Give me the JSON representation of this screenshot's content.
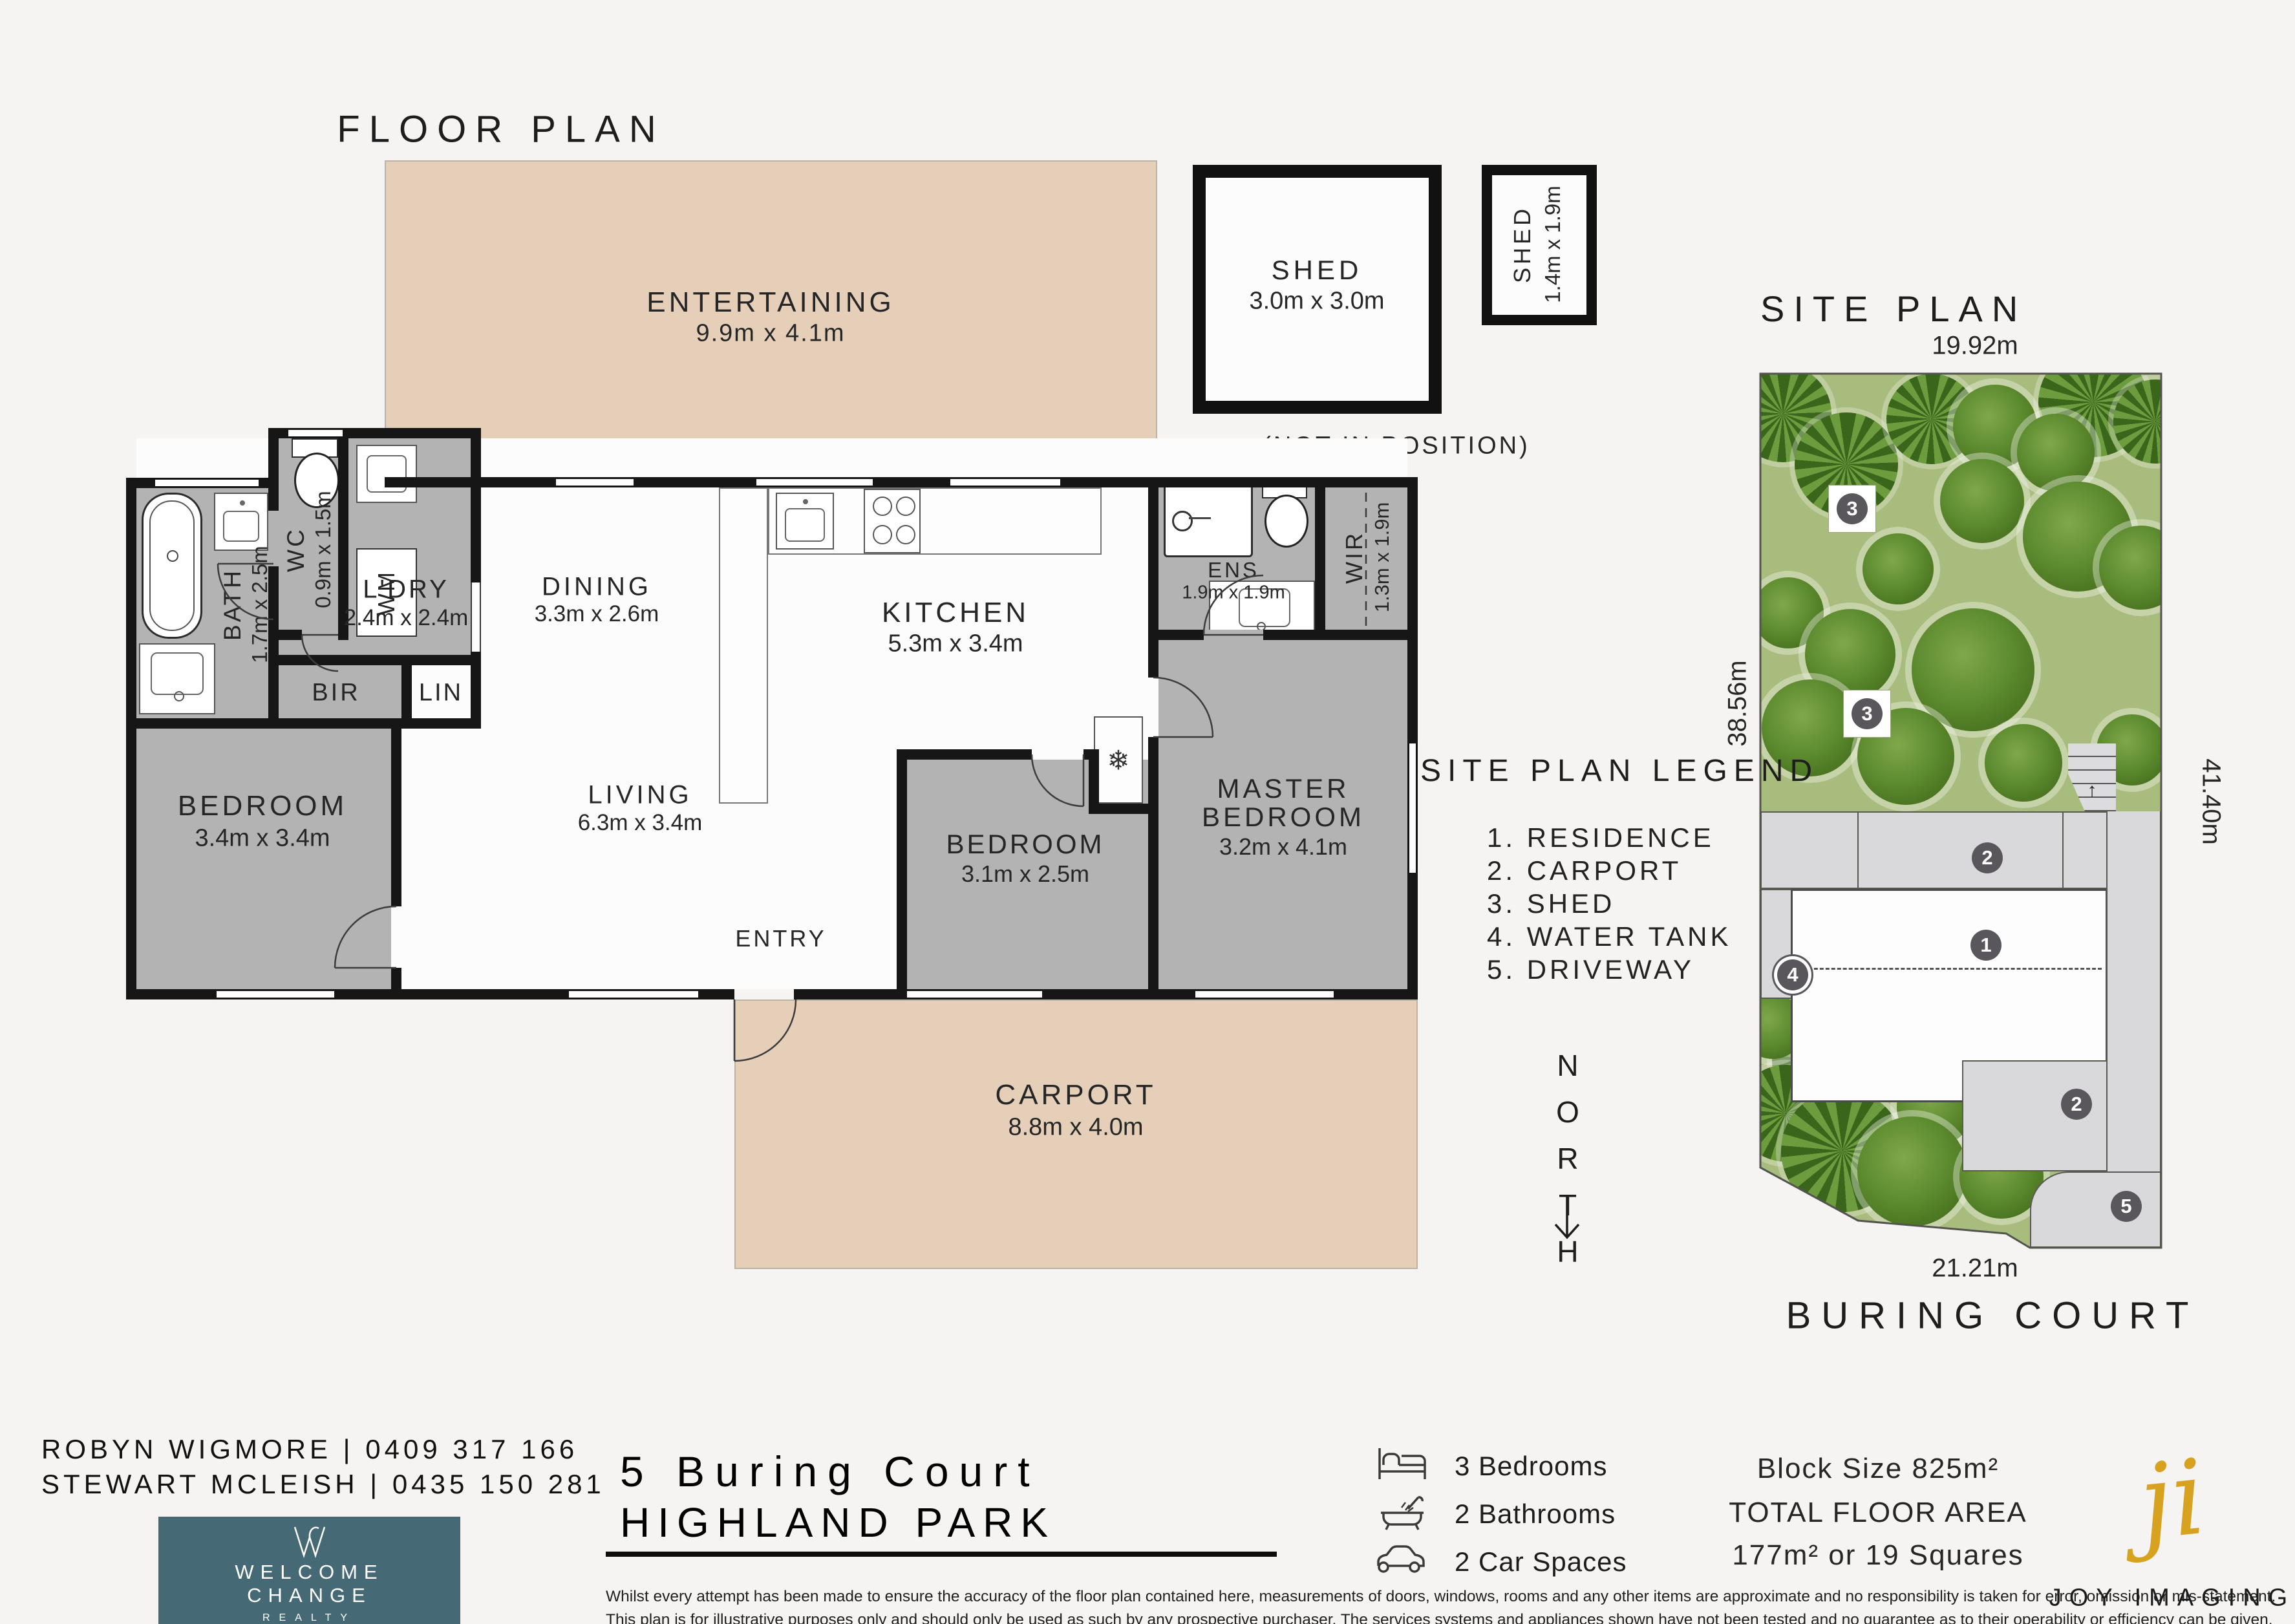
{
  "floor_plan": {
    "title": "FLOOR PLAN",
    "not_in_position": "(NOT IN POSITION)",
    "entry_label": "ENTRY",
    "rooms": {
      "entertaining": {
        "name": "ENTERTAINING",
        "dims": "9.9m x 4.1m"
      },
      "shed_large": {
        "name": "SHED",
        "dims": "3.0m x 3.0m"
      },
      "shed_small": {
        "name": "SHED",
        "dims": "1.4m x 1.9m"
      },
      "dining": {
        "name": "DINING",
        "dims": "3.3m x 2.6m"
      },
      "kitchen": {
        "name": "KITCHEN",
        "dims": "5.3m x 3.4m"
      },
      "living": {
        "name": "LIVING",
        "dims": "6.3m x 3.4m"
      },
      "bedroom1": {
        "name": "BEDROOM",
        "dims": "3.4m x 3.4m"
      },
      "bedroom2": {
        "name": "BEDROOM",
        "dims": "3.1m x 2.5m"
      },
      "master": {
        "name_line1": "MASTER",
        "name_line2": "BEDROOM",
        "dims": "3.2m x 4.1m"
      },
      "bath": {
        "name": "BATH",
        "dims": "1.7m x 2.5m"
      },
      "wc": {
        "name": "WC",
        "dims": "0.9m x 1.5m"
      },
      "laundry": {
        "name": "L'DRY",
        "dims": "2.4m x 2.4m"
      },
      "ens": {
        "name": "ENS",
        "dims": "1.9m x 1.9m"
      },
      "wir": {
        "name": "WIR",
        "dims": "1.3m x 1.9m"
      },
      "carport": {
        "name": "CARPORT",
        "dims": "8.8m x 4.0m"
      },
      "bir": {
        "name": "BIR"
      },
      "lin": {
        "name": "LIN"
      },
      "wm": {
        "name": "WM"
      }
    },
    "icons": {
      "fridge": "❄"
    }
  },
  "site_plan": {
    "title": "SITE PLAN",
    "street": "BURING COURT",
    "north_label": "NORTH",
    "measurements": {
      "top": "19.92m",
      "left": "38.56m",
      "right": "41.40m",
      "bottom": "21.21m"
    },
    "legend": {
      "title": "SITE PLAN LEGEND",
      "items": [
        "1. RESIDENCE",
        "2. CARPORT",
        "3. SHED",
        "4. WATER TANK",
        "5. DRIVEWAY"
      ]
    },
    "marker_numbers": {
      "residence": "1",
      "carport": "2",
      "shed": "3",
      "water_tank": "4",
      "driveway": "5"
    }
  },
  "footer": {
    "agents": [
      "ROBYN WIGMORE | 0409 317 166",
      "STEWART MCLEISH | 0435 150 281"
    ],
    "agency": {
      "name_line1": "WELCOME",
      "name_line2": "CHANGE",
      "name_line3": "REALTY"
    },
    "address_line1": "5 Buring Court",
    "address_line2": "HIGHLAND PARK",
    "features": [
      {
        "icon": "bed-icon",
        "label": "3 Bedrooms"
      },
      {
        "icon": "bath-icon",
        "label": "2 Bathrooms"
      },
      {
        "icon": "car-icon",
        "label": "2 Car Spaces"
      }
    ],
    "area": {
      "block": "Block Size 825m²",
      "floor_title": "TOTAL FLOOR AREA",
      "floor_value": "177m² or 19 Squares"
    },
    "credit": {
      "logo": "ji",
      "name": "JOY IMAGING"
    },
    "disclaimer": [
      "Whilst every attempt has been made to ensure the accuracy of the floor plan contained here, measurements of doors, windows, rooms and any other items are approximate and no responsibility is taken for error, omission or mis-statement.",
      "This plan is for illustrative purposes only and should only be used as such by any prospective purchaser. The services systems and appliances shown have not been tested and no guarantee as to their operability or efficiency can be given."
    ]
  },
  "colors": {
    "beige": "#e5cfb8",
    "room_gray": "#b3b3b3",
    "wall": "#161616",
    "grass": "#a8bc7d",
    "paving": "#d9d9db",
    "teal": "#456a75",
    "gold": "#d7a21f"
  }
}
